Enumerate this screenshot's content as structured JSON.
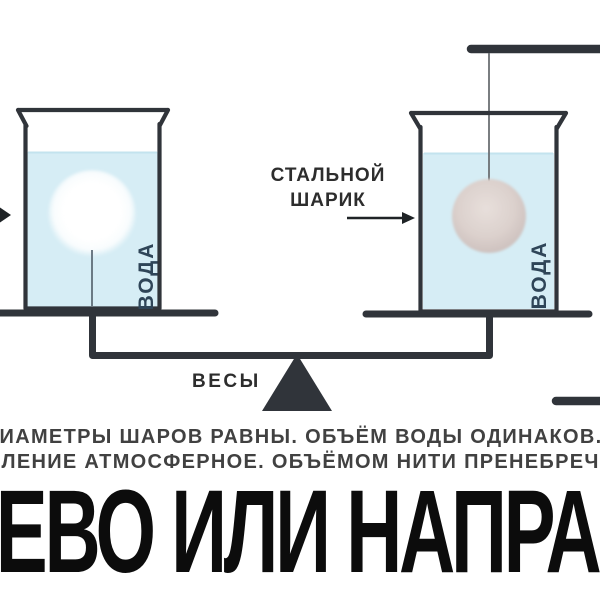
{
  "colors": {
    "outline": "#30343a",
    "water": "#d6edf5",
    "steel_ball": "#dcd1cd",
    "white_ball": "#ffffff",
    "label_text": "#2d2d2d",
    "voda_text": "#2f4558",
    "caption_text": "#414141",
    "question_text": "#0c0c0c"
  },
  "labels": {
    "steel_ball_line1": "СТАЛЬНОЙ",
    "steel_ball_line2": "ШАРИК",
    "water_left": "ВОДА",
    "water_right": "ВОДА",
    "scales": "ВЕСЫ"
  },
  "caption": {
    "line1": "ДИАМЕТРЫ ШАРОВ РАВНЫ. ОБЪЁМ ВОДЫ ОДИНАКОВ.",
    "line2": "ДАВЛЕНИЕ АТМОСФЕРНОЕ. ОБЪЁМОМ НИТИ ПРЕНЕБРЕЧЬ."
  },
  "question": "ВЛЕВО ИЛИ НАПРАВО"
}
